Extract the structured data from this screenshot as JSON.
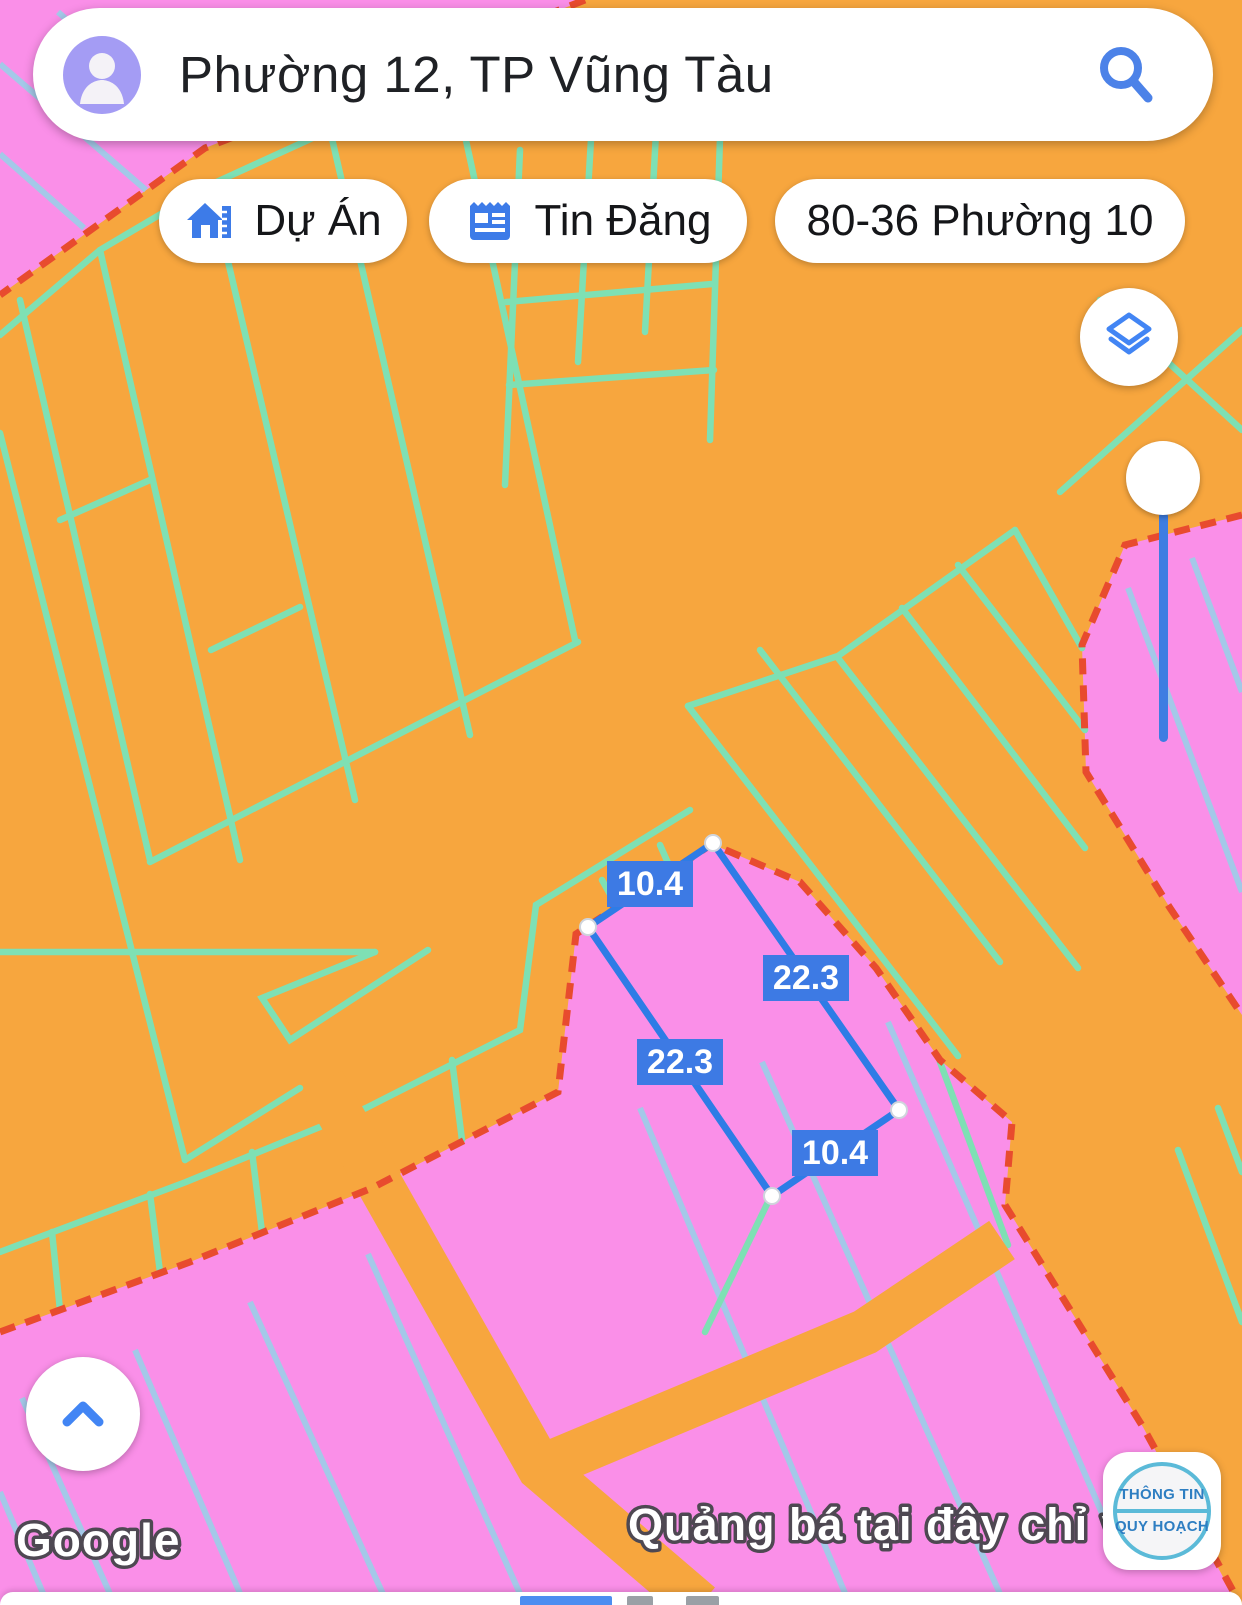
{
  "search": {
    "query": "Phường 12, TP Vũng Tàu"
  },
  "chips": {
    "project": {
      "label": "Dự Án"
    },
    "listings": {
      "label": "Tin Đăng"
    },
    "address": {
      "label": "80-36 Phường 10"
    }
  },
  "map": {
    "measurements": {
      "top": "10.4",
      "right": "22.3",
      "left": "22.3",
      "bottom": "10.4"
    },
    "zone_colors": {
      "orange_zone": "#F7A63E",
      "pink_zone": "#FA8FE8",
      "parcel_line_teal": "#7EE0B4",
      "parcel_line_blue": "#A4C8E8",
      "zone_boundary_red": "#E84B2E",
      "measure_line_blue": "#2E7CE6",
      "measure_label_bg": "#3D7AE4",
      "ui_accent_blue": "#1A73E8"
    }
  },
  "footer": {
    "watermark": "Google",
    "ad_text": "Quảng bá tại đây chỉ vớ"
  },
  "badge": {
    "line1": "THÔNG TIN",
    "line2": "QUY HOẠCH"
  }
}
